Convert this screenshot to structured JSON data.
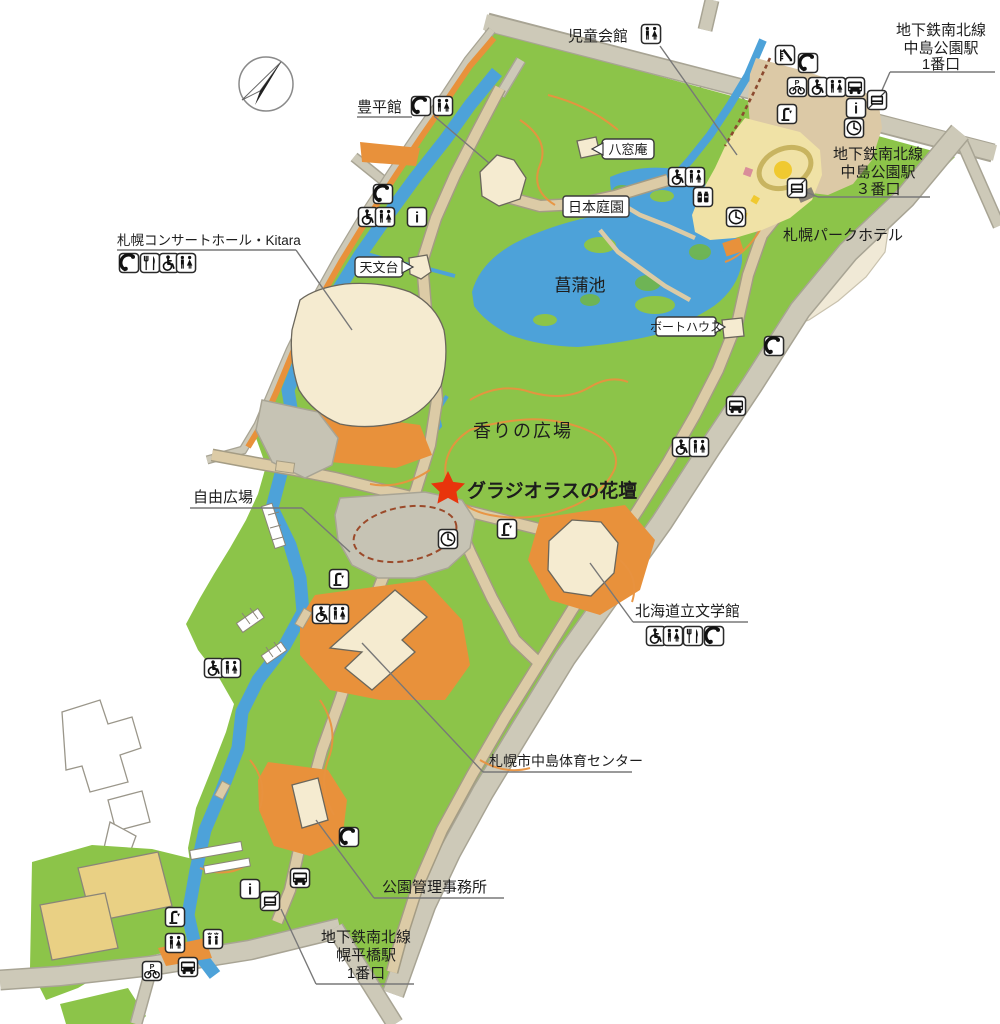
{
  "map_title": "中島公園 園内マップ",
  "labels": {
    "jido_kaikan": "児童会館",
    "station1": [
      "地下鉄南北線",
      "中島公園駅",
      "1番口"
    ],
    "station3": [
      "地下鉄南北線",
      "中島公園駅",
      "３番口"
    ],
    "hoheikan": "豊平館",
    "hassoan": "八窓庵",
    "nihon_teien": "日本庭園",
    "park_hotel": "札幌パークホテル",
    "kitara": "札幌コンサートホール・Kitara",
    "tenmondai": "天文台",
    "shobuike": "菖蒲池",
    "boathouse": "ボートハウス",
    "kaori_hiroba": "香りの広場",
    "gladiolus": "グラジオラスの花壇",
    "jiyu_hiroba": "自由広場",
    "bungakukan": "北海道立文学館",
    "taiiku_center": "札幌市中島体育センター",
    "kanri_jimusho": "公園管理事務所",
    "horohirabashi": [
      "地下鉄南北線",
      "幌平橋駅",
      "1番口"
    ]
  },
  "colors": {
    "park_green": "#8CC449",
    "water_blue": "#4DA2D9",
    "road_gray": "#CDC9B8",
    "path_tan": "#DCCBA6",
    "trail_orange": "#E8923F",
    "building_cream": "#F5EBD0",
    "highlight_red": "#E8340C",
    "pond_label_navy": "#1B3F5E"
  },
  "icons": [
    {
      "t": "toilet",
      "x": 651,
      "y": 34
    },
    {
      "t": "slide",
      "x": 785,
      "y": 55
    },
    {
      "t": "phone",
      "x": 808,
      "y": 63
    },
    {
      "t": "bicycle",
      "x": 797,
      "y": 87
    },
    {
      "t": "wheelchair",
      "x": 818,
      "y": 87
    },
    {
      "t": "toilet",
      "x": 836,
      "y": 87
    },
    {
      "t": "bus",
      "x": 855,
      "y": 87
    },
    {
      "t": "subway",
      "x": 877,
      "y": 100
    },
    {
      "t": "info",
      "x": 856,
      "y": 108
    },
    {
      "t": "clock",
      "x": 854,
      "y": 128
    },
    {
      "t": "fountain",
      "x": 787,
      "y": 114
    },
    {
      "t": "subway",
      "x": 797,
      "y": 188
    },
    {
      "t": "phone",
      "x": 421,
      "y": 106
    },
    {
      "t": "toilet",
      "x": 443,
      "y": 106
    },
    {
      "t": "wheelchair",
      "x": 678,
      "y": 177
    },
    {
      "t": "toilet",
      "x": 695,
      "y": 177
    },
    {
      "t": "vending",
      "x": 703,
      "y": 197
    },
    {
      "t": "clock",
      "x": 736,
      "y": 217
    },
    {
      "t": "phone",
      "x": 383,
      "y": 194
    },
    {
      "t": "wheelchair",
      "x": 368,
      "y": 217
    },
    {
      "t": "toilet",
      "x": 385,
      "y": 217
    },
    {
      "t": "info",
      "x": 417,
      "y": 217
    },
    {
      "t": "phone",
      "x": 129,
      "y": 263
    },
    {
      "t": "restaurant",
      "x": 150,
      "y": 263
    },
    {
      "t": "wheelchair",
      "x": 169,
      "y": 263
    },
    {
      "t": "toilet",
      "x": 186,
      "y": 263
    },
    {
      "t": "phone",
      "x": 774,
      "y": 346
    },
    {
      "t": "bus",
      "x": 736,
      "y": 406
    },
    {
      "t": "wheelchair",
      "x": 682,
      "y": 447
    },
    {
      "t": "toilet",
      "x": 699,
      "y": 447
    },
    {
      "t": "clock",
      "x": 448,
      "y": 539
    },
    {
      "t": "fountain",
      "x": 507,
      "y": 529
    },
    {
      "t": "fountain",
      "x": 339,
      "y": 579
    },
    {
      "t": "wheelchair",
      "x": 322,
      "y": 614
    },
    {
      "t": "toilet",
      "x": 339,
      "y": 614
    },
    {
      "t": "wheelchair",
      "x": 214,
      "y": 668
    },
    {
      "t": "toilet",
      "x": 231,
      "y": 668
    },
    {
      "t": "wheelchair",
      "x": 656,
      "y": 636
    },
    {
      "t": "toilet",
      "x": 673,
      "y": 636
    },
    {
      "t": "restaurant",
      "x": 693,
      "y": 636
    },
    {
      "t": "phone",
      "x": 714,
      "y": 636
    },
    {
      "t": "phone",
      "x": 349,
      "y": 837
    },
    {
      "t": "bus",
      "x": 300,
      "y": 878
    },
    {
      "t": "info",
      "x": 250,
      "y": 889
    },
    {
      "t": "subway",
      "x": 270,
      "y": 901
    },
    {
      "t": "fountain",
      "x": 175,
      "y": 917
    },
    {
      "t": "toilet",
      "x": 175,
      "y": 943
    },
    {
      "t": "shower",
      "x": 213,
      "y": 939
    },
    {
      "t": "bicycle",
      "x": 152,
      "y": 971
    },
    {
      "t": "bus",
      "x": 188,
      "y": 967
    }
  ]
}
